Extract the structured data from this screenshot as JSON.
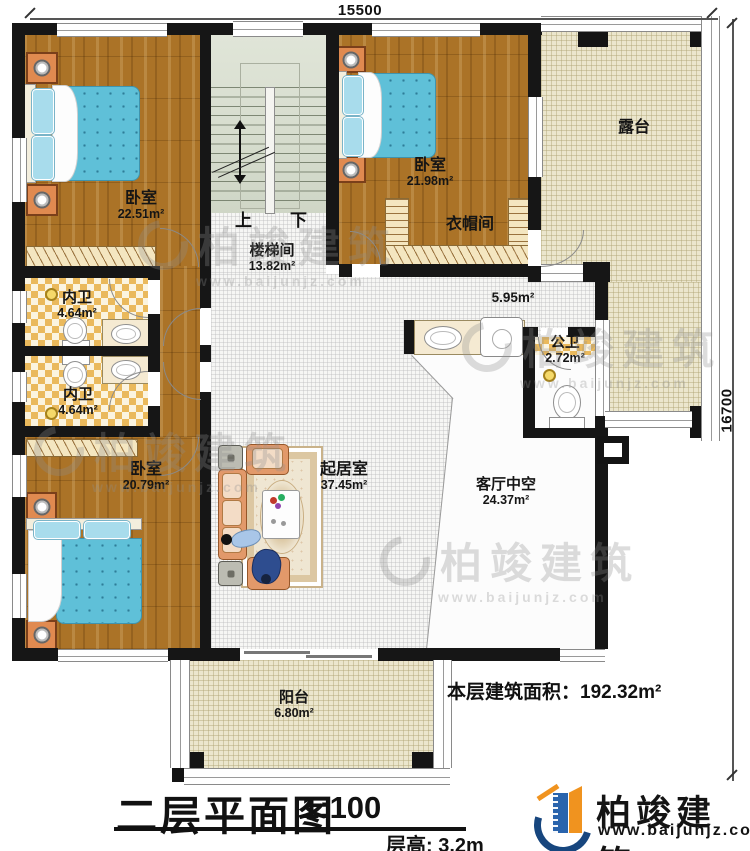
{
  "plan": {
    "dimensions": {
      "top": "15500",
      "right": "16700"
    },
    "stairs": {
      "up": "上",
      "down": "下"
    },
    "rooms": {
      "bedroom_tl": {
        "name": "卧室",
        "area": "22.51m²"
      },
      "bedroom_tr": {
        "name": "卧室",
        "area": "21.98m²"
      },
      "bedroom_bl": {
        "name": "卧室",
        "area": "20.79m²"
      },
      "stairwell": {
        "name": "楼梯间",
        "area": "13.82m²"
      },
      "cloakroom": {
        "name": "衣帽间"
      },
      "terrace": {
        "name": "露台"
      },
      "bath_inner_top": {
        "name": "内卫",
        "area": "4.64m²"
      },
      "bath_inner_bottom": {
        "name": "内卫",
        "area": "4.64m²"
      },
      "bath_public": {
        "name": "公卫",
        "area": "2.72m²"
      },
      "wash_area": {
        "area": "5.95m²"
      },
      "living": {
        "name": "起居室",
        "area": "37.45m²"
      },
      "living_void": {
        "name": "客厅中空",
        "area": "24.37m²"
      },
      "balcony": {
        "name": "阳台",
        "area": "6.80m²"
      }
    }
  },
  "title_block": {
    "title": "二层平面图",
    "scale": "1:100",
    "floor_height": "层高: 3.2m",
    "floor_area": "本层建筑面积：192.32m²"
  },
  "brand": {
    "name": "柏竣建筑",
    "url": "www.baijunjz.com"
  },
  "watermark": {
    "text": "柏竣建筑",
    "url": "www.baijunjz.com"
  },
  "colors": {
    "brand_blue": "#17467e",
    "brand_orange": "#f0931f",
    "bed_blue": "#5fc0d8",
    "wood": "#ab7327"
  }
}
